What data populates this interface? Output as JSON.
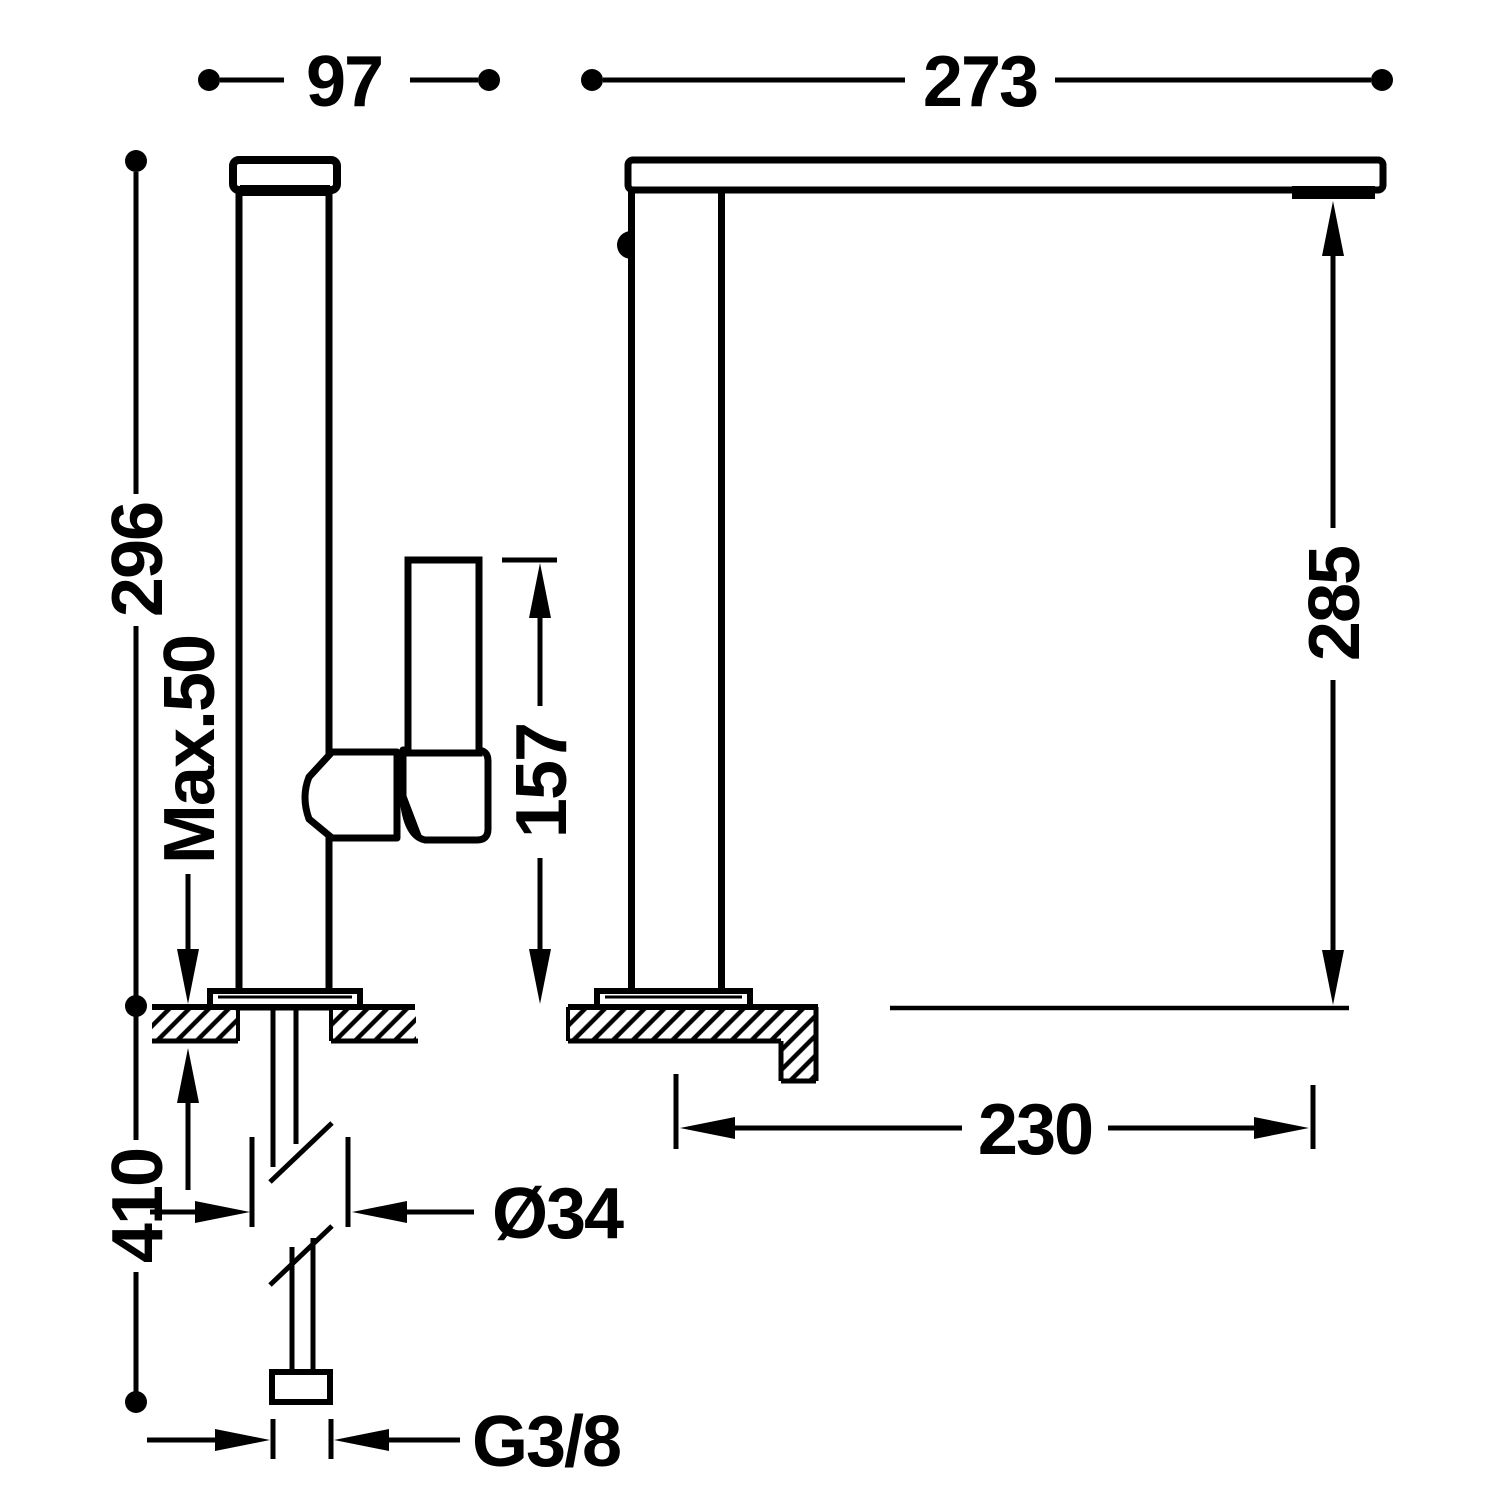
{
  "drawing": {
    "kind": "technical-dimension-diagram",
    "colors": {
      "ink": "#000000",
      "paper": "#ffffff"
    },
    "dimensions": {
      "width_97": "97",
      "reach_273": "273",
      "height_296": "296",
      "max_counter_thickness": "Max.50",
      "handle_height_157": "157",
      "spout_height_285": "285",
      "hose_length_410": "410",
      "projection_230": "230",
      "shank_diameter": "Ø34",
      "thread_size": "G3/8"
    }
  }
}
